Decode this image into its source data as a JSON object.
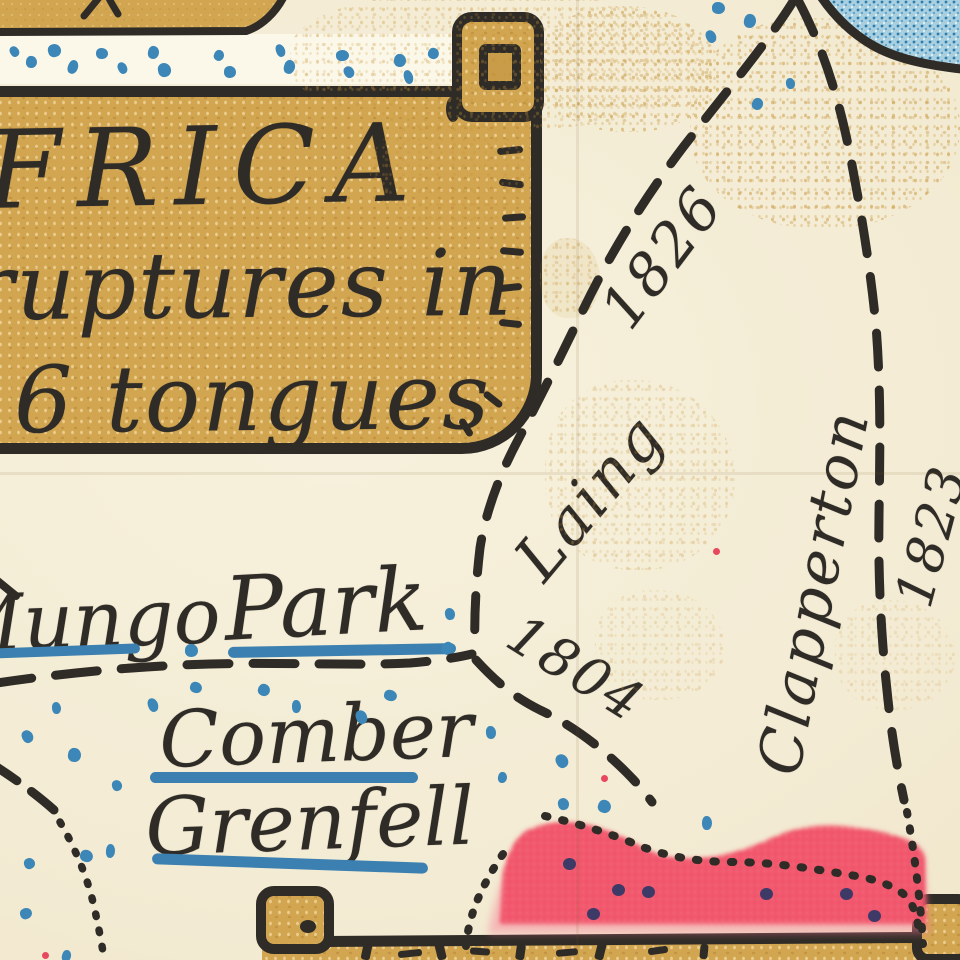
{
  "cartouche": {
    "line1": "FRICA",
    "line2": "ruptures in",
    "line3": "6 tongues"
  },
  "labels": [
    {
      "id": "mungo",
      "text": "Mungo",
      "x": -58,
      "y": 587,
      "size": 78,
      "rot": -2,
      "ul": {
        "x": -12,
        "y": 646,
        "w": 152,
        "h": 10,
        "rot": -2
      }
    },
    {
      "id": "park",
      "text": "Park",
      "x": 222,
      "y": 566,
      "size": 88,
      "rot": -3,
      "ul": {
        "x": 228,
        "y": 645,
        "w": 228,
        "h": 11,
        "rot": -1
      }
    },
    {
      "id": "comber",
      "text": "Comber",
      "x": 158,
      "y": 702,
      "size": 78,
      "rot": -2,
      "ul": {
        "x": 150,
        "y": 772,
        "w": 268,
        "h": 11,
        "rot": 0
      }
    },
    {
      "id": "grenfell",
      "text": "Grenfell",
      "x": 144,
      "y": 788,
      "size": 80,
      "rot": -2,
      "ul": {
        "x": 152,
        "y": 858,
        "w": 276,
        "h": 11,
        "rot": 2
      }
    },
    {
      "id": "laing",
      "text": "Laing",
      "cx": 590,
      "cy": 497,
      "size": 62,
      "rot": -50
    },
    {
      "id": "year-1826",
      "text": "1826",
      "cx": 662,
      "cy": 257,
      "size": 58,
      "rot": -53
    },
    {
      "id": "year-1804",
      "text": "1804",
      "cx": 576,
      "cy": 669,
      "size": 54,
      "rot": 32
    },
    {
      "id": "clapperton",
      "text": "Clapperton",
      "cx": 814,
      "cy": 592,
      "size": 60,
      "rot": -79
    },
    {
      "id": "year-1823",
      "text": "1823",
      "cx": 932,
      "cy": 536,
      "size": 52,
      "rot": -75
    }
  ],
  "colors": {
    "ink": "#2f2b26",
    "paper": "#f4edd8",
    "scroll_tan": "#d2a651",
    "route_blue": "#3c87b7",
    "underline_blue": "#3b80b0",
    "red_area": "#f2415e",
    "lake_blue": "#a8cfe0",
    "navy_dot": "#3d3a68",
    "ochre_speckle": "#c69438"
  },
  "decor": {
    "blue_dots": [
      [
        10,
        46
      ],
      [
        26,
        56
      ],
      [
        48,
        44
      ],
      [
        68,
        60
      ],
      [
        96,
        48
      ],
      [
        118,
        62
      ],
      [
        148,
        46
      ],
      [
        158,
        63
      ],
      [
        214,
        50
      ],
      [
        224,
        66
      ],
      [
        276,
        44
      ],
      [
        284,
        60
      ],
      [
        336,
        50
      ],
      [
        344,
        66
      ],
      [
        394,
        54
      ],
      [
        404,
        70
      ],
      [
        428,
        48
      ],
      [
        712,
        2
      ],
      [
        706,
        30
      ],
      [
        744,
        14
      ],
      [
        786,
        78
      ],
      [
        752,
        98
      ],
      [
        185,
        644
      ],
      [
        148,
        698
      ],
      [
        190,
        682
      ],
      [
        52,
        702
      ],
      [
        22,
        730
      ],
      [
        68,
        748
      ],
      [
        112,
        780
      ],
      [
        258,
        684
      ],
      [
        292,
        700
      ],
      [
        356,
        710
      ],
      [
        384,
        690
      ],
      [
        445,
        608
      ],
      [
        442,
        642
      ],
      [
        106,
        844
      ],
      [
        24,
        858
      ],
      [
        80,
        850
      ],
      [
        486,
        726
      ],
      [
        556,
        754
      ],
      [
        498,
        772
      ],
      [
        558,
        798
      ],
      [
        598,
        800
      ],
      [
        702,
        816
      ],
      [
        20,
        908
      ],
      [
        62,
        950
      ]
    ],
    "navy_dots": [
      [
        563,
        858
      ],
      [
        612,
        884
      ],
      [
        642,
        886
      ],
      [
        587,
        908
      ],
      [
        760,
        888
      ],
      [
        840,
        888
      ],
      [
        868,
        910
      ]
    ],
    "red_specks": [
      [
        713,
        548
      ],
      [
        601,
        775
      ],
      [
        42,
        952
      ]
    ],
    "ink_fragments": [
      [
        362,
        944,
        9,
        16,
        12
      ],
      [
        398,
        950,
        24,
        7,
        -6
      ],
      [
        436,
        942,
        9,
        18,
        -14
      ],
      [
        470,
        948,
        20,
        7,
        4
      ],
      [
        516,
        944,
        9,
        16,
        8
      ],
      [
        556,
        949,
        22,
        7,
        -5
      ],
      [
        596,
        942,
        9,
        18,
        14
      ],
      [
        648,
        947,
        20,
        7,
        -8
      ],
      [
        700,
        944,
        8,
        15,
        6
      ]
    ]
  }
}
